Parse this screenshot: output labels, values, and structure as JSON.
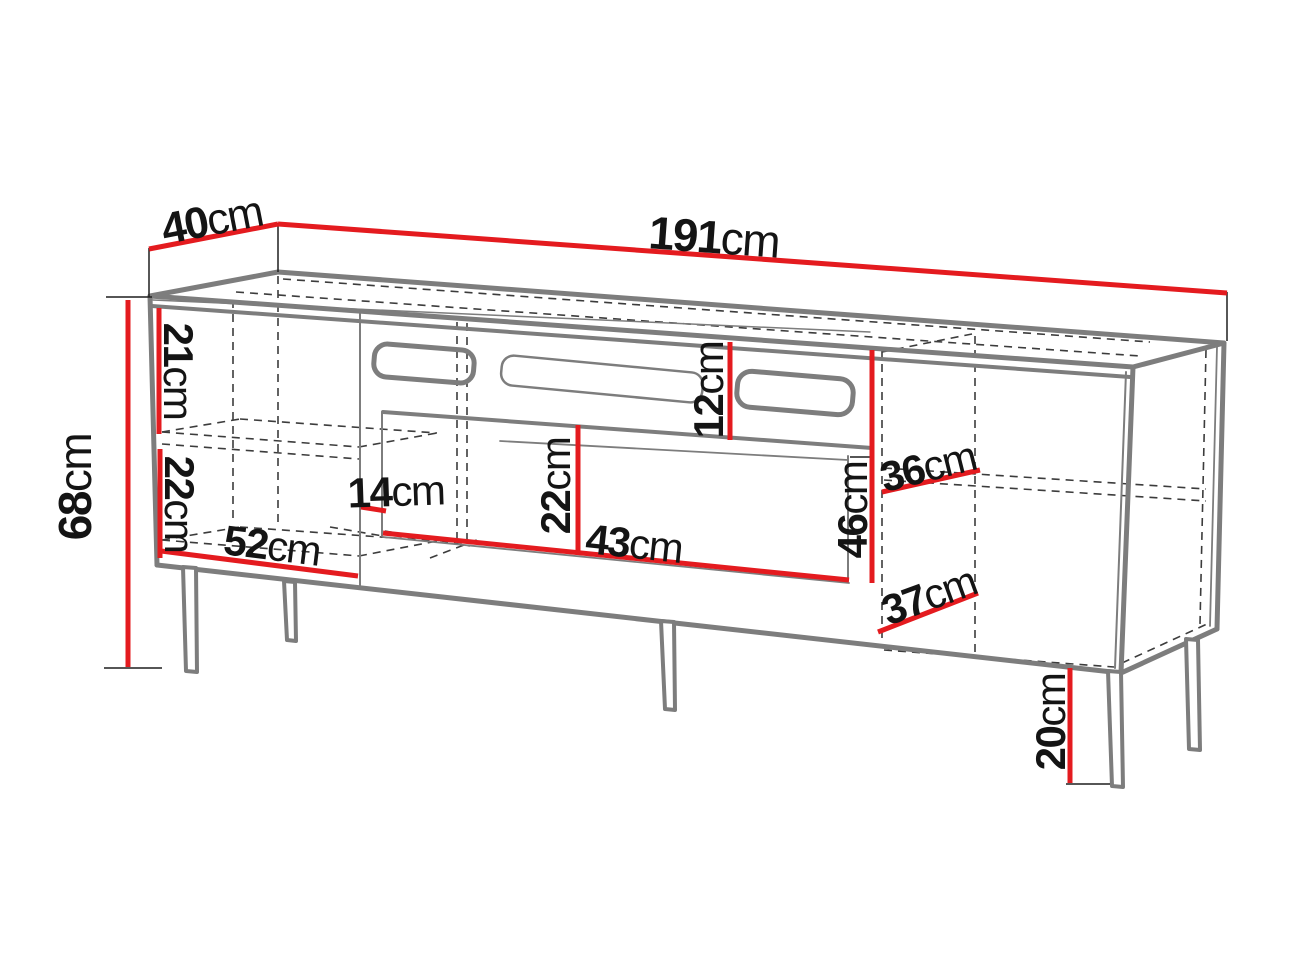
{
  "diagram": {
    "type": "furniture-dimension-diagram",
    "subject": "TV stand / sideboard technical line drawing with dimension lines",
    "unit": "cm",
    "colors": {
      "dimension_line": "#e41b1f",
      "cabinet_edge": "#7d7d7d",
      "hidden_edge": "#3c3c3c",
      "tick_line": "#1f1f1f",
      "text": "#141414",
      "background": "#ffffff"
    },
    "dimensions": {
      "total_height": {
        "value": "68",
        "unit": "cm"
      },
      "depth": {
        "value": "40",
        "unit": "cm"
      },
      "total_width": {
        "value": "191",
        "unit": "cm"
      },
      "left_upper_compartment_height": {
        "value": "21",
        "unit": "cm"
      },
      "left_lower_compartment_height": {
        "value": "22",
        "unit": "cm"
      },
      "left_compartment_width": {
        "value": "52",
        "unit": "cm"
      },
      "center_gap": {
        "value": "14",
        "unit": "cm"
      },
      "drawer_front_height": {
        "value": "22",
        "unit": "cm"
      },
      "drawer_front_width": {
        "value": "43",
        "unit": "cm"
      },
      "top_niche_height": {
        "value": "12",
        "unit": "cm"
      },
      "right_compartment_height": {
        "value": "46",
        "unit": "cm"
      },
      "right_upper_shelf_depth": {
        "value": "36",
        "unit": "cm"
      },
      "right_lower_shelf_depth": {
        "value": "37",
        "unit": "cm"
      },
      "leg_height": {
        "value": "20",
        "unit": "cm"
      }
    }
  }
}
